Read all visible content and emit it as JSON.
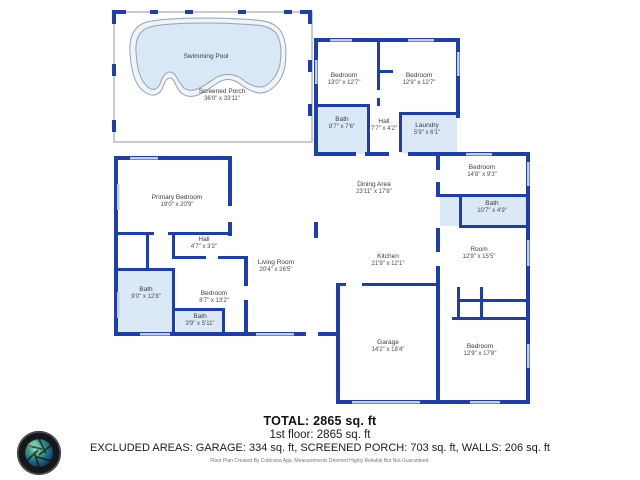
{
  "plan": {
    "rooms": [
      {
        "name": "Swimming Pool",
        "dims": ""
      },
      {
        "name": "Screened Porch",
        "dims": "36'0\" x 33'11\""
      },
      {
        "name": "Bedroom",
        "dims": "13'0\" x 12'7\""
      },
      {
        "name": "Bedroom",
        "dims": "12'9\" x 12'7\""
      },
      {
        "name": "Bath",
        "dims": "8'7\" x 7'6\""
      },
      {
        "name": "Hall",
        "dims": "7'7\" x 4'2\""
      },
      {
        "name": "Laundry",
        "dims": "5'9\" x 6'1\""
      },
      {
        "name": "Bedroom",
        "dims": "14'8\" x 9'3\""
      },
      {
        "name": "Bath",
        "dims": "10'7\" x 4'9\""
      },
      {
        "name": "Room",
        "dims": "12'9\" x 15'5\""
      },
      {
        "name": "Bedroom",
        "dims": "12'9\" x 17'8\""
      },
      {
        "name": "Dining Area",
        "dims": "23'11\" x 17'8\""
      },
      {
        "name": "Kitchen",
        "dims": "21'9\" x 12'1\""
      },
      {
        "name": "Living Room",
        "dims": "20'4\" x 26'5\""
      },
      {
        "name": "Garage",
        "dims": "14'2\" x 18'4\""
      },
      {
        "name": "Primary Bedroom",
        "dims": "19'0\" x 20'9\""
      },
      {
        "name": "Hall",
        "dims": "4'7\" x 3'2\""
      },
      {
        "name": "Bath",
        "dims": "9'0\" x 12'8\""
      },
      {
        "name": "Bedroom",
        "dims": "8'7\" x 13'2\""
      },
      {
        "name": "Bath",
        "dims": "3'9\" x 5'11\""
      }
    ],
    "colors": {
      "wall": "#1e3eae",
      "room_fill": "#dbe9f7",
      "pool_fill": "#d8e8f6",
      "window": "#c9cfd9"
    }
  },
  "footer": {
    "total": "TOTAL: 2865 sq. ft",
    "floor": "1st floor: 2865 sq. ft",
    "excluded": "EXCLUDED AREAS: GARAGE: 334 sq. ft, SCREENED PORCH: 703 sq. ft, WALLS: 206 sq. ft",
    "disclaimer": "Floor Plan Created By Cubicasa App. Measurements Deemed Highly Reliable But Not Guaranteed."
  }
}
